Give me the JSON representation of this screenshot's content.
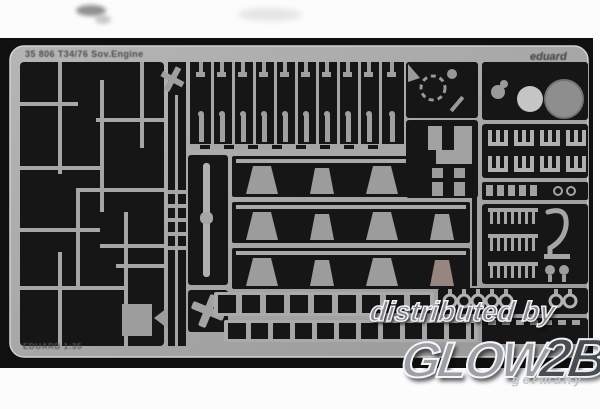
{
  "page": {
    "background_color": "#fcfcfc"
  },
  "photo": {
    "background_color": "#101010",
    "fret_color": "#a6a6a6",
    "top_left_label": "35 806 T34/76 Sov.Engine",
    "top_right_brand": "eduard",
    "bottom_left_label": "EDUARD 1:35"
  },
  "watermark": {
    "distributed_by": "distributed by",
    "logo_main": "GLOW",
    "logo_accent": "2B",
    "country": "germany",
    "text_color": "#9aa0a6",
    "accent_color": "#474d52"
  }
}
